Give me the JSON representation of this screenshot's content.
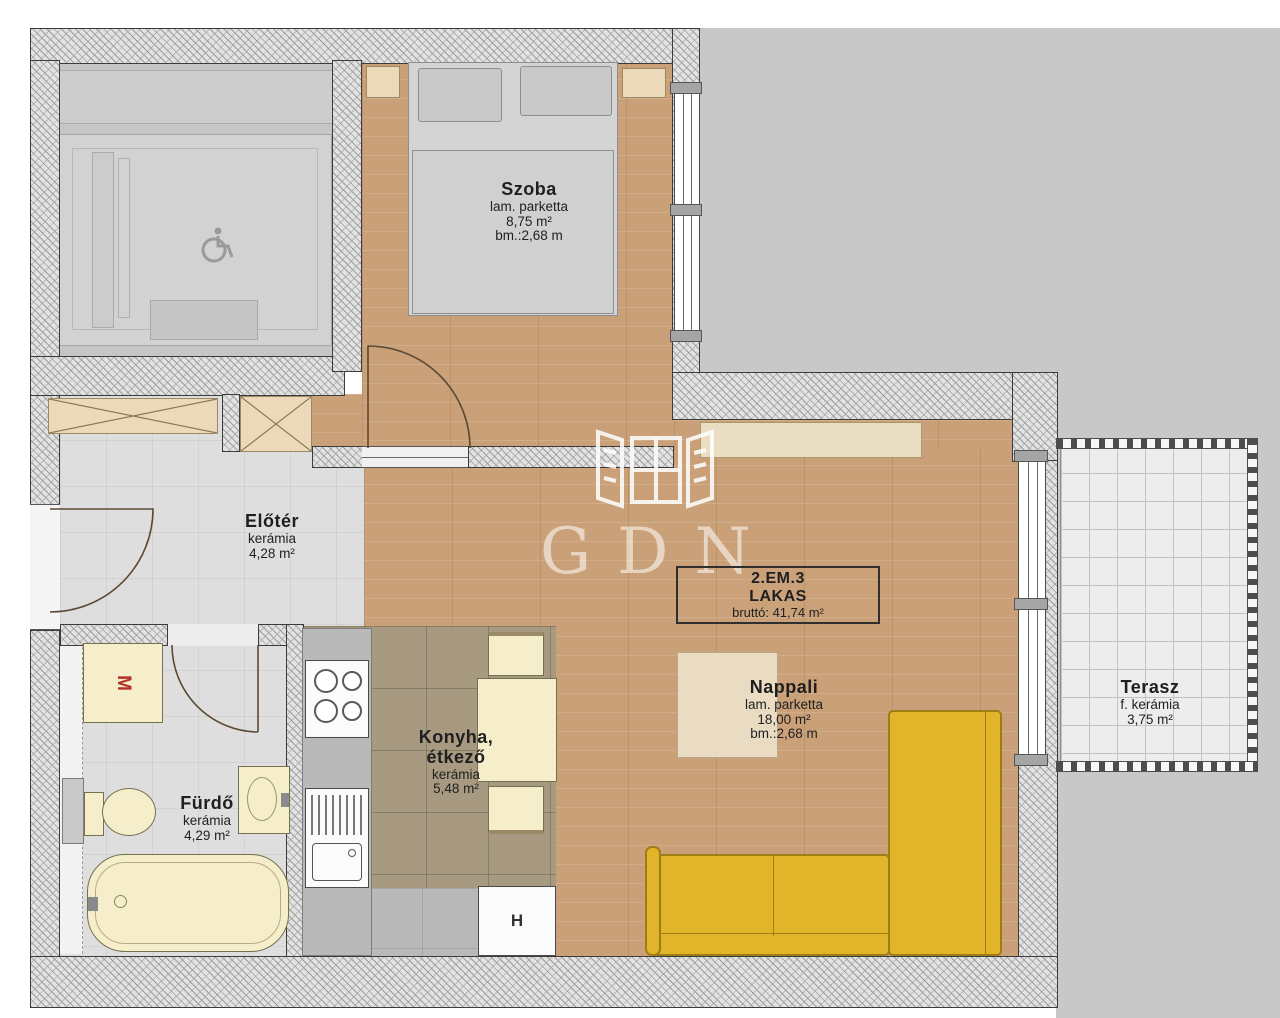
{
  "watermark": {
    "text": "GDN"
  },
  "unit_label": {
    "line1": "2.EM.3",
    "line2": "LAKAS",
    "line3": "bruttó: 41,74 m²"
  },
  "rooms": {
    "szoba": {
      "name": "Szoba",
      "floor": "lam. parketta",
      "area": "8,75 m²",
      "height": "bm.:2,68 m"
    },
    "eloter": {
      "name": "Előtér",
      "floor": "kerámia",
      "area": "4,28 m²"
    },
    "furdo": {
      "name": "Fürdő",
      "floor": "kerámia",
      "area": "4,29 m²"
    },
    "konyha": {
      "name1": "Konyha,",
      "name2": "étkező",
      "floor": "kerámia",
      "area": "5,48 m²"
    },
    "nappali": {
      "name": "Nappali",
      "floor": "lam. parketta",
      "area": "18,00 m²",
      "height": "bm.:2,68 m"
    },
    "terasz": {
      "name": "Terasz",
      "floor": "f. kerámia",
      "area": "3,75 m²"
    }
  },
  "appliances": {
    "washing_machine": "M",
    "fridge": "H"
  },
  "colors": {
    "sofa_yellow": "#e2b42a",
    "wood_floor": "#c9a077",
    "kitchen_tile": "#a79a81",
    "outside_gray": "#c8c8c8",
    "fixture_cream": "#f6eecb",
    "washer_letter_red": "#b23229"
  }
}
